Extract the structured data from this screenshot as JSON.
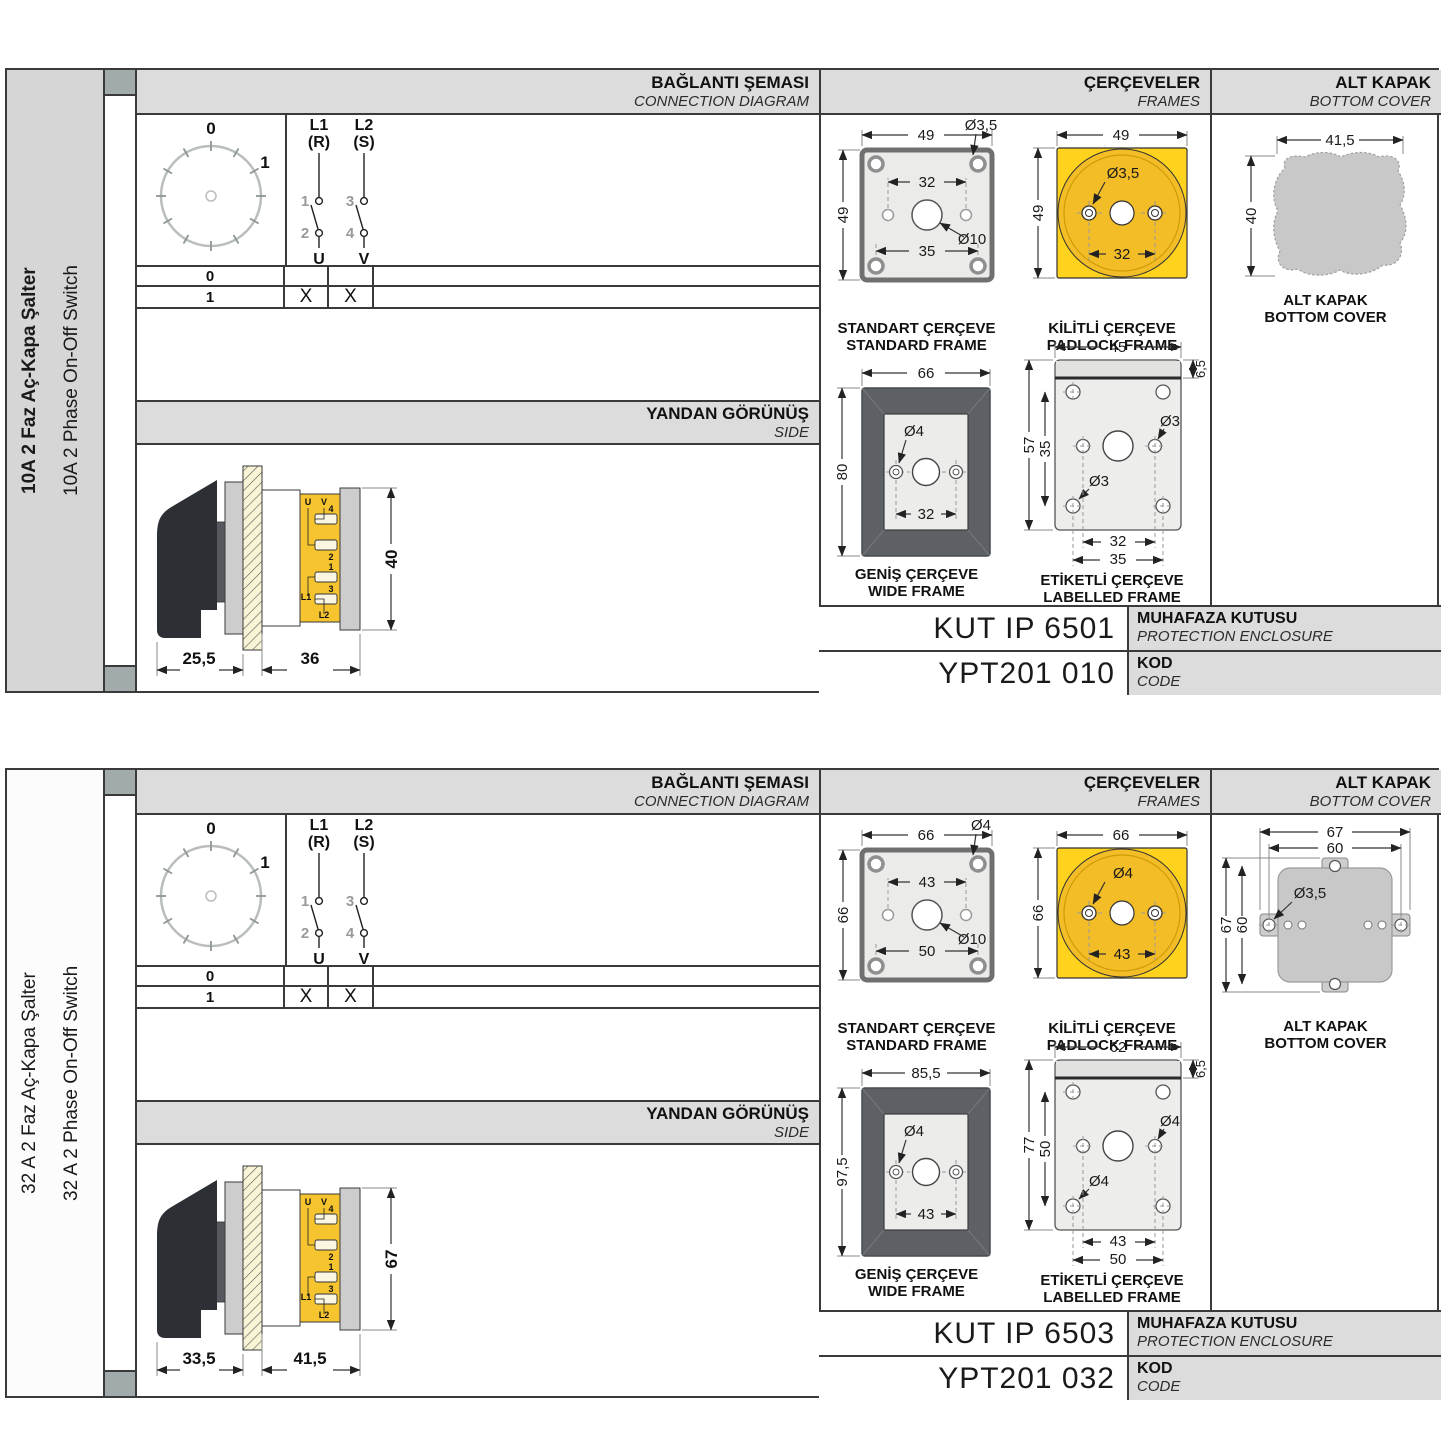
{
  "colors": {
    "accent_yellow": "#f6c42e",
    "padlock_yellow": "#ffd31d",
    "frame_dark": "#5d6165",
    "header_gray": "#dcdcdc",
    "cover_gray": "#c8c8c8",
    "border": "#3a3a3a"
  },
  "shared": {
    "headers": {
      "connection_tr": "BAĞLANTI ŞEMASI",
      "connection_en": "CONNECTION DIAGRAM",
      "frames_tr": "ÇERÇEVELER",
      "frames_en": "FRAMES",
      "cover_tr": "ALT KAPAK",
      "cover_en": "BOTTOM COVER",
      "side_tr": "YANDAN GÖRÜNÜŞ",
      "side_en": "SIDE"
    },
    "captions": {
      "standard_tr": "STANDART ÇERÇEVE",
      "standard_en": "STANDARD FRAME",
      "padlock_tr": "KİLİTLİ ÇERÇEVE",
      "padlock_en": "PADLOCK FRAME",
      "wide_tr": "GENİŞ ÇERÇEVE",
      "wide_en": "WIDE FRAME",
      "labelled_tr": "ETİKETLİ ÇERÇEVE",
      "labelled_en": "LABELLED FRAME",
      "cover_tr": "ALT KAPAK",
      "cover_en": "BOTTOM COVER",
      "enclosure_tr": "MUHAFAZA KUTUSU",
      "enclosure_en": "PROTECTION ENCLOSURE",
      "code_tr": "KOD",
      "code_en": "CODE"
    },
    "diagram": {
      "pos0": "0",
      "pos1": "1",
      "l1": "L1",
      "l1_phase": "(R)",
      "l2": "L2",
      "l2_phase": "(S)",
      "t1": "1",
      "t2": "2",
      "t3": "3",
      "t4": "4",
      "u": "U",
      "v": "V",
      "row0": {
        "pos": "0",
        "u": "",
        "v": ""
      },
      "row1": {
        "pos": "1",
        "u": "X",
        "v": "X"
      }
    },
    "terminals": {
      "u": "U",
      "v": "V",
      "n1": "1",
      "n2": "2",
      "n3": "3",
      "n4": "4",
      "l1": "L1",
      "l2": "L2"
    }
  },
  "sections": [
    {
      "title_tr": "10A 2 Faz Aç-Kapa Şalter",
      "title_en": "10A 2 Phase On-Off Switch",
      "side_view": {
        "front_depth": "25,5",
        "body_depth": "36",
        "height": "40"
      },
      "standard_frame": {
        "width": "49",
        "height": "49",
        "corner_hole": "Ø3,5",
        "hole_span_top": "32",
        "center_hole": "Ø10",
        "hole_span_bottom": "35"
      },
      "padlock_frame": {
        "width": "49",
        "height": "49",
        "hole": "Ø3,5",
        "hole_span": "32"
      },
      "wide_frame": {
        "width": "66",
        "height": "80",
        "hole": "Ø4",
        "hole_span": "32"
      },
      "labelled_frame": {
        "width": "45",
        "strip_height": "6,5",
        "height": "57",
        "hole_span_v": "35",
        "hole_upper": "Ø3",
        "hole_lower": "Ø3",
        "span_inner": "32",
        "span_outer": "35"
      },
      "bottom_cover": {
        "width": "41,5",
        "height": "40"
      },
      "enclosure_code": "KUT IP 6501",
      "order_code": "YPT201 010"
    },
    {
      "title_tr": "32 A 2 Faz Aç-Kapa Şalter",
      "title_en": "32 A 2 Phase On-Off Switch",
      "side_view": {
        "front_depth": "33,5",
        "body_depth": "41,5",
        "height": "67"
      },
      "standard_frame": {
        "width": "66",
        "height": "66",
        "corner_hole": "Ø4",
        "hole_span_top": "43",
        "center_hole": "Ø10",
        "hole_span_bottom": "50"
      },
      "padlock_frame": {
        "width": "66",
        "height": "66",
        "hole": "Ø4",
        "hole_span": "43"
      },
      "wide_frame": {
        "width": "85,5",
        "height": "97,5",
        "hole": "Ø4",
        "hole_span": "43"
      },
      "labelled_frame": {
        "width": "62",
        "strip_height": "6,5",
        "height": "77",
        "hole_span_v": "50",
        "hole_upper": "Ø4",
        "hole_lower": "Ø4",
        "span_inner": "43",
        "span_outer": "50"
      },
      "bottom_cover": {
        "width_outer": "67",
        "width_inner": "60",
        "height_outer": "67",
        "height_inner": "60",
        "hole": "Ø3,5"
      },
      "enclosure_code": "KUT IP 6503",
      "order_code": "YPT201 032"
    }
  ]
}
